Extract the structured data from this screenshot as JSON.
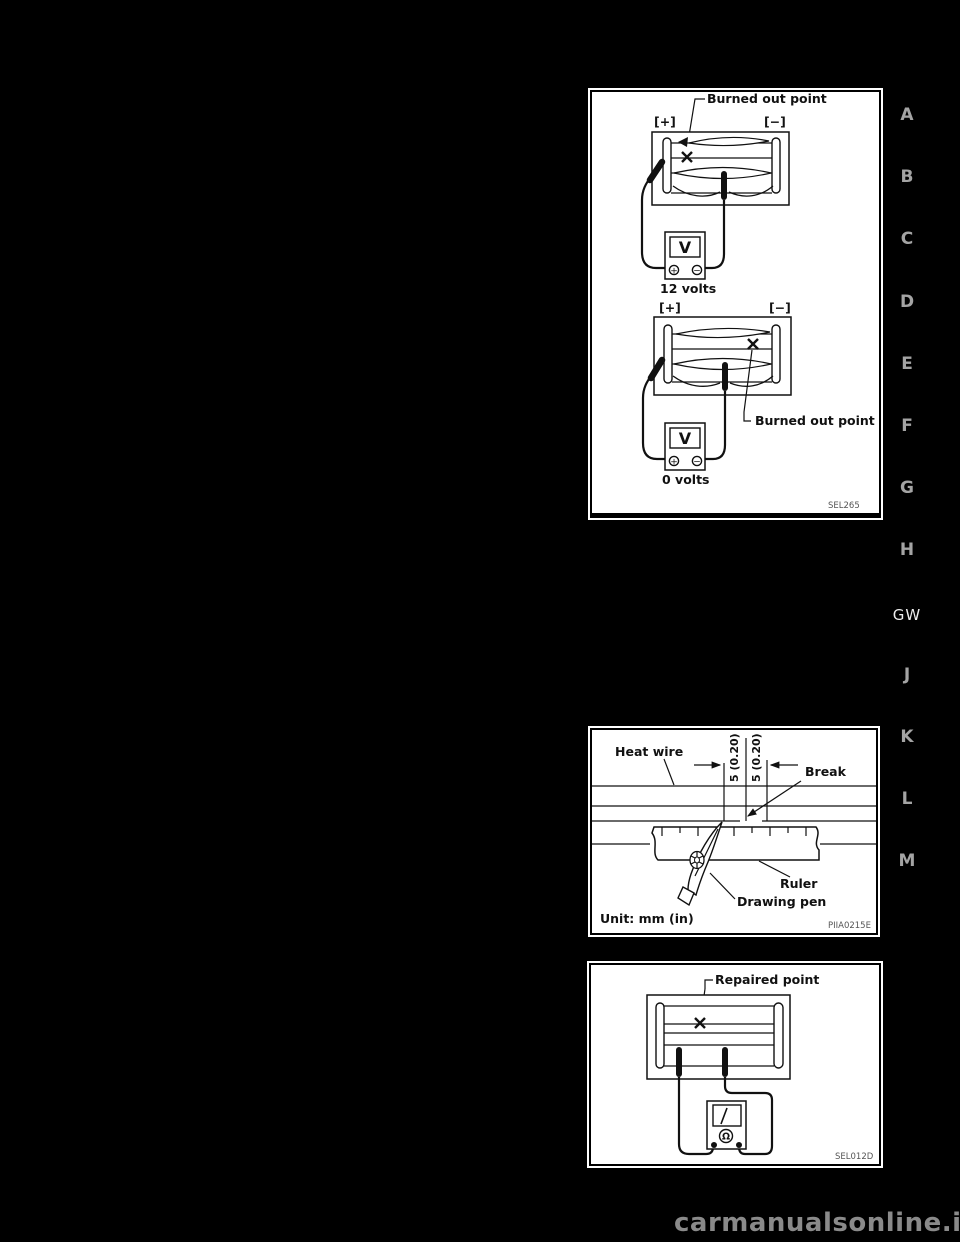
{
  "page": {
    "watermark": "carmanualsonline.info"
  },
  "tabs": {
    "active_label": "GW",
    "items": [
      {
        "label": "A"
      },
      {
        "label": "B"
      },
      {
        "label": "C"
      },
      {
        "label": "D"
      },
      {
        "label": "E"
      },
      {
        "label": "F"
      },
      {
        "label": "G"
      },
      {
        "label": "H"
      },
      {
        "label": "GW"
      },
      {
        "label": "J"
      },
      {
        "label": "K"
      },
      {
        "label": "L"
      },
      {
        "label": "M"
      }
    ]
  },
  "figures": {
    "voltage_check": {
      "code": "SEL265",
      "burned_out_point_top": "Burned out point",
      "burned_out_point_bottom": "Burned out point",
      "positive_terminal": "[+]",
      "negative_terminal": "[−]",
      "meter_letter": "V",
      "plus_sign": "+",
      "minus_sign": "−",
      "reading_high": "12 volts",
      "reading_zero": "0 volts"
    },
    "repair_measure": {
      "code": "PIIA0215E",
      "heat_wire": "Heat wire",
      "break_label": "Break",
      "dimension_left": "5 (0.20)",
      "dimension_right": "5 (0.20)",
      "ruler": "Ruler",
      "drawing_pen": "Drawing pen",
      "unit": "Unit: mm (in)"
    },
    "repair_check": {
      "code": "SEL012D",
      "repaired_point": "Repaired point",
      "ohm_symbol": "Ω"
    }
  }
}
